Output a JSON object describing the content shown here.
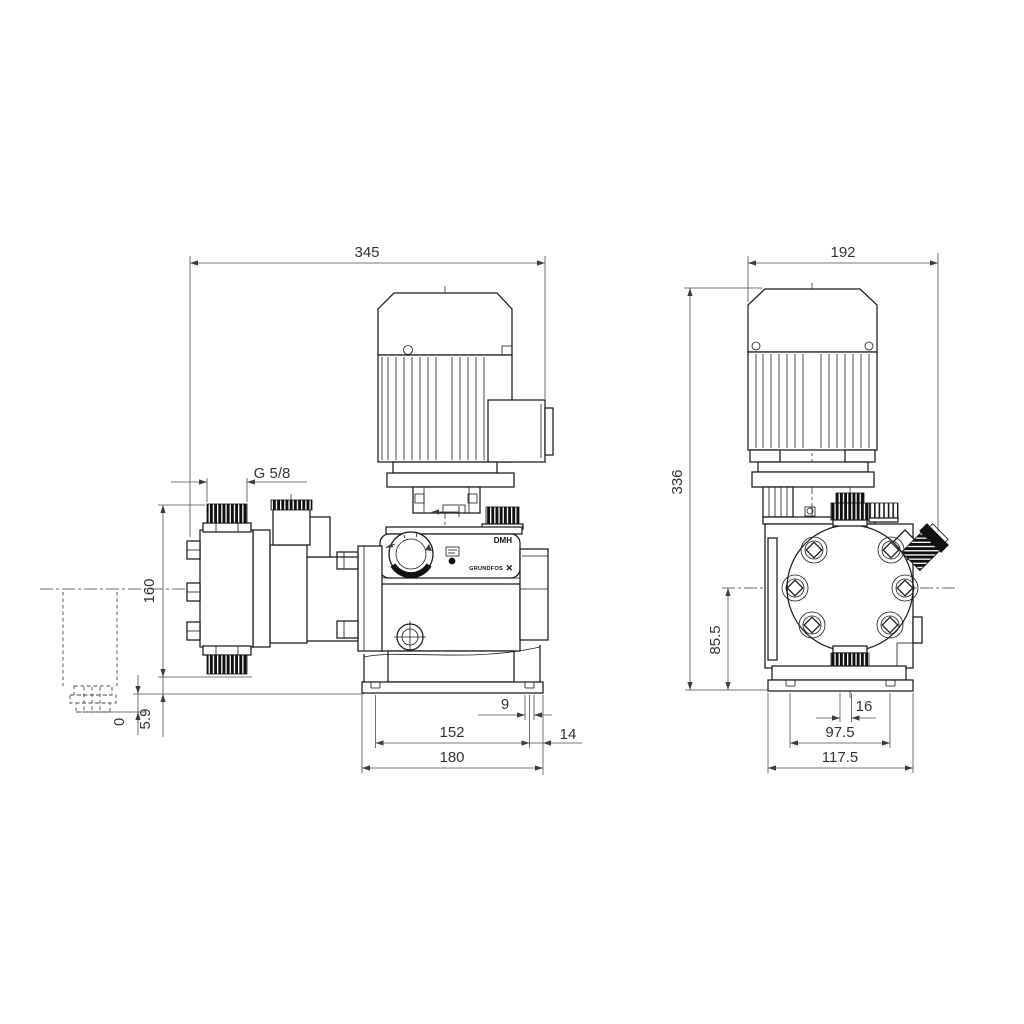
{
  "front_view": {
    "width_total": "345",
    "thread_size": "G 5/8",
    "port_span": "160",
    "datum": "0",
    "foot_offset": "5.9",
    "slot_width": "9",
    "slot_spacing": "152",
    "slot_edge_offset": "14",
    "base_width": "180",
    "model": "DMH",
    "brand": "GRUNDFOS",
    "logo_mark": "✕"
  },
  "side_view": {
    "width_total": "192",
    "height_total": "336",
    "port_center_height": "85.5",
    "slot_center_offset": "16",
    "slot_spacing": "97.5",
    "base_width": "117.5"
  }
}
